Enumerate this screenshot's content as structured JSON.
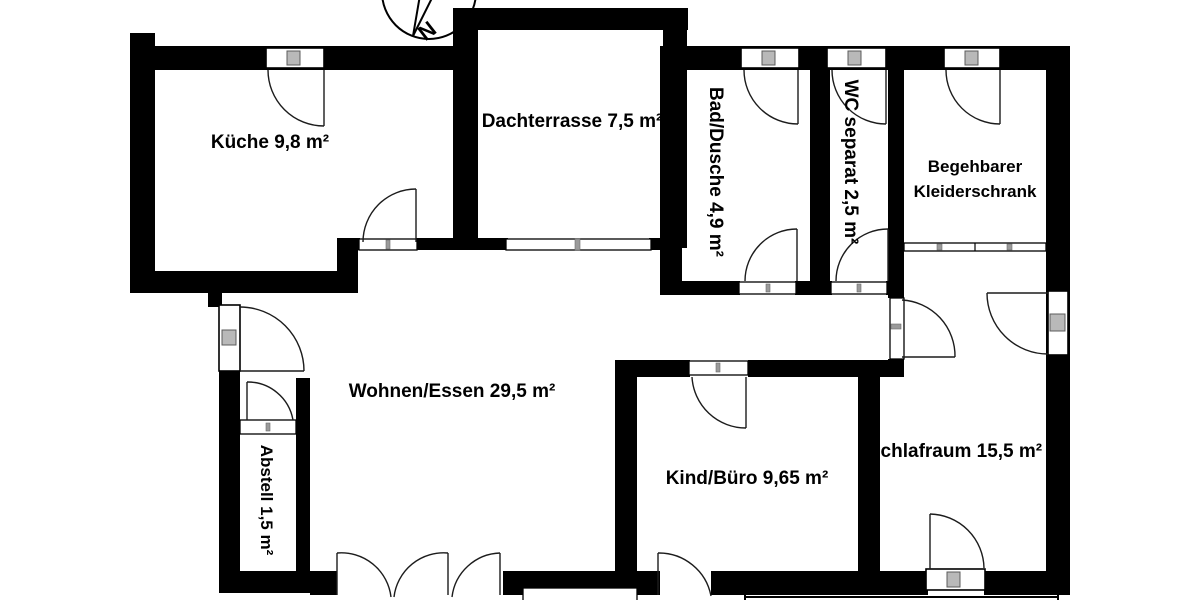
{
  "floorplan": {
    "compass": {
      "north_label": "N"
    },
    "rooms": [
      {
        "id": "kueche",
        "label": "Küche 9,8 m²"
      },
      {
        "id": "dachterrasse",
        "label": "Dachterrasse 7,5 m²"
      },
      {
        "id": "bad_dusche",
        "label": "Bad/Dusche 4,9 m²"
      },
      {
        "id": "wc_separat",
        "label": "WC separat 2,5 m²"
      },
      {
        "id": "kleiderschrank",
        "label_line1": "Begehbarer",
        "label_line2": "Kleiderschrank"
      },
      {
        "id": "wohnen_essen",
        "label": "Wohnen/Essen 29,5 m²"
      },
      {
        "id": "abstell",
        "label": "Abstell 1,5 m²"
      },
      {
        "id": "kind_buero",
        "label": "Kind/Büro 9,65 m²"
      },
      {
        "id": "schlafraum",
        "label": "Schlafraum 15,5 m²"
      }
    ],
    "colors": {
      "wall": "#000000",
      "background": "#ffffff",
      "line": "#1c1c1c",
      "handle_fill": "#b9b9b9",
      "handle_stroke": "#5c5c5c"
    }
  }
}
